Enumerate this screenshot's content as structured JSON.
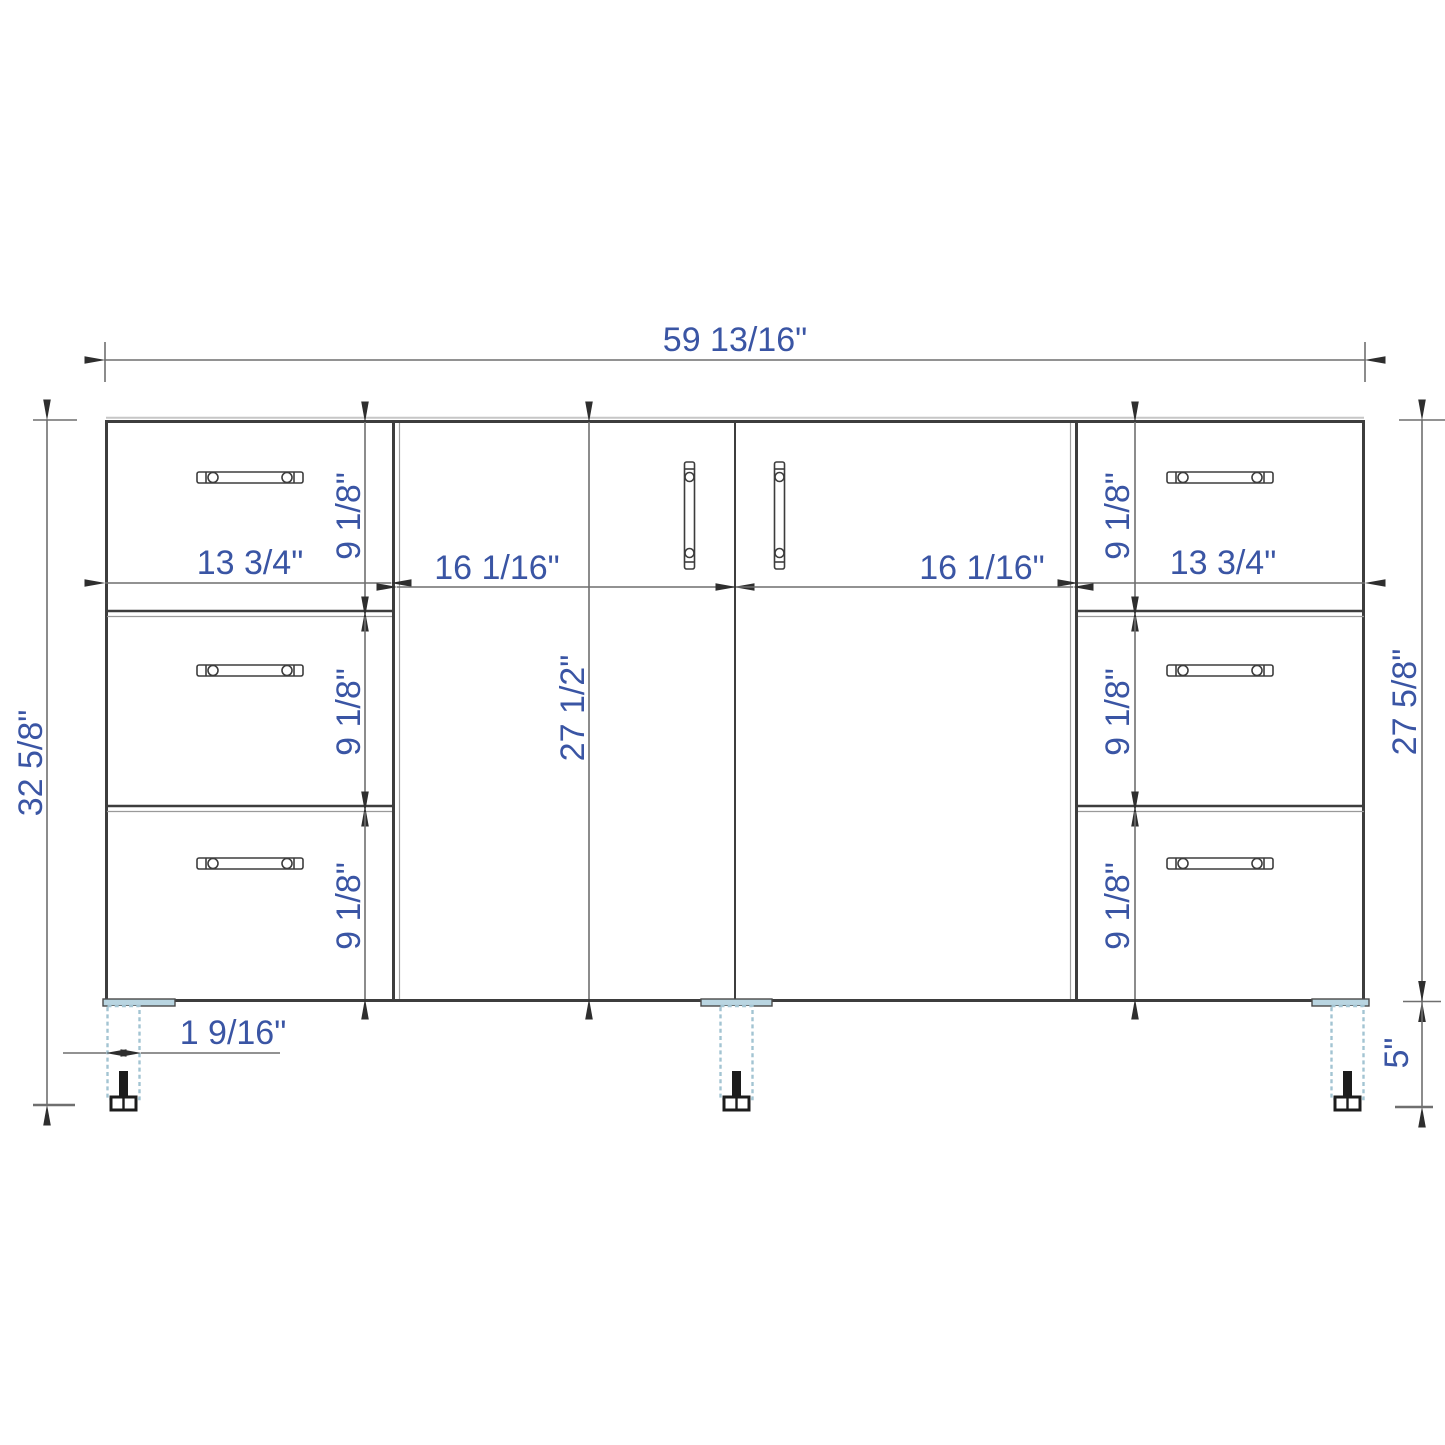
{
  "drawing": {
    "type": "technical-dimension-diagram",
    "subject": "Front elevation of a freestanding vanity cabinet: two center doors, two side drawer banks (3 drawers each), on three legs",
    "units": "inches",
    "colors": {
      "background": "#ffffff",
      "cabinet_line": "#3d3d3d",
      "dimension_line": "#6f6f6f",
      "arrowhead": "#2e2e2e",
      "dimension_text": "#3a55a4",
      "leg_dashed_outline": "#a3c4d2",
      "leg_plate_fill": "#b9d5e1",
      "bolt": "#1c1c1c"
    },
    "dims": {
      "overall_width": "59 13/16\"",
      "overall_height": "32 5/8\"",
      "cabinet_height": "27 5/8\"",
      "leg_height": "5\"",
      "bank_width_left": "13 3/4\"",
      "bank_width_right": "13 3/4\"",
      "door_width_left": "16 1/16\"",
      "door_width_right": "16 1/16\"",
      "door_height": "27 1/2\"",
      "drawer_heights": [
        "9 1/8\"",
        "9 1/8\"",
        "9 1/8\"",
        "9 1/8\"",
        "9 1/8\"",
        "9 1/8\""
      ],
      "leg_width": "1 9/16\""
    }
  }
}
